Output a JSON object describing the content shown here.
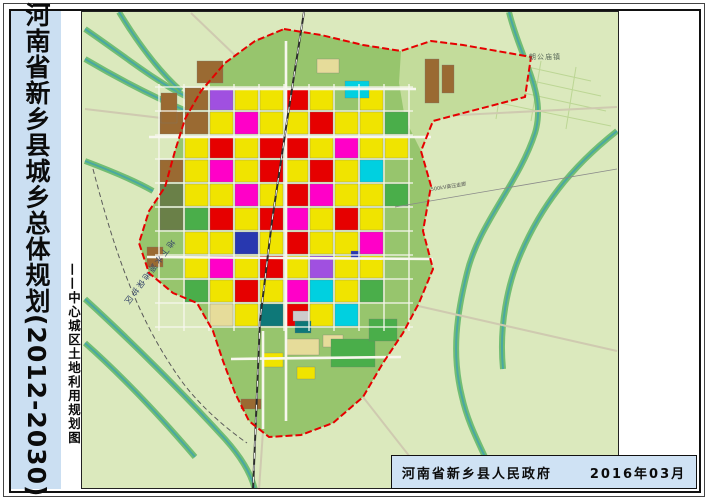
{
  "page": {
    "title_vertical": "河南省新乡县城乡总体规划(2012-2030)",
    "subtitle_vertical": "——中心城区土地利用规划图",
    "publisher": "河南省新乡县人民政府",
    "date": "2016年03月"
  },
  "compass": {
    "north_label": "N"
  },
  "scalebar": {
    "labels": [
      "500",
      "0",
      "500",
      "1000",
      "1500",
      "2000m"
    ]
  },
  "legend": {
    "title": "图 例",
    "items": [
      {
        "label": "二类居住用地",
        "color": "#f5ec00",
        "style": "solid"
      },
      {
        "label": "行政办公用地",
        "color": "#ff00c8",
        "style": "solid"
      },
      {
        "label": "文化设施用地",
        "color": "#e478dc",
        "style": "solid"
      },
      {
        "label": "教育科研用地",
        "color": "#ff8c8c",
        "style": "solid"
      },
      {
        "label": "中小学用地",
        "color": "#ff8c8c",
        "style": "stripes"
      },
      {
        "label": "医疗卫生用地",
        "color": "#ff9aa0",
        "style": "cross"
      },
      {
        "label": "社会福利用地",
        "color": "#ff78a0",
        "style": "solid"
      },
      {
        "label": "宗教用地",
        "color": "#d29020",
        "style": "solid"
      },
      {
        "label": "商业用地",
        "color": "#ff0000",
        "style": "solid"
      },
      {
        "label": "市场用地",
        "color": "#f03060",
        "style": "solid"
      },
      {
        "label": "商务用地",
        "color": "#d83050",
        "style": "solid"
      },
      {
        "label": "娱乐康体用地",
        "color": "#ff5c9e",
        "style": "solid"
      },
      {
        "label": "加油加气站用地",
        "color": "#a81028",
        "style": "solid"
      },
      {
        "label": "公用设施营业网点用地",
        "color": "#e84868",
        "style": "solid"
      },
      {
        "label": "一类工业用地",
        "color": "#d7b285",
        "style": "solid"
      },
      {
        "label": "二类工业用地",
        "color": "#b5855a",
        "style": "solid"
      },
      {
        "label": "三类工业用地",
        "color": "#8a5a32",
        "style": "solid"
      },
      {
        "label": "物流仓储用地",
        "color": "#a86ad8",
        "style": "solid"
      },
      {
        "label": "交通枢纽用地",
        "color": "#8f8f8f",
        "style": "solid"
      },
      {
        "label": "公交首末站用地",
        "color": "#a8a8a8",
        "style": "solid"
      },
      {
        "label": "社会停车场用地",
        "color": "#c4c4cc",
        "style": "solid"
      },
      {
        "label": "供水设施用地",
        "color": "#38bcd8",
        "style": "solid"
      },
      {
        "label": "供电设施用地",
        "color": "#2638a8",
        "style": "solid"
      },
      {
        "label": "通信设施用地",
        "color": "#4868d0",
        "style": "solid"
      },
      {
        "label": "污水处理厂",
        "color": "#0e7878",
        "style": "solid"
      },
      {
        "label": "消防设施用地",
        "color": "#3048c0",
        "style": "solid"
      },
      {
        "label": "公园绿地",
        "color": "#2fae4f",
        "style": "solid"
      },
      {
        "label": "防护绿地",
        "color": "#67b967",
        "style": "solid"
      },
      {
        "label": "广场用地",
        "color": "#d9d9d9",
        "style": "solid"
      },
      {
        "label": "水域",
        "color": "#a6daf2",
        "style": "solid"
      },
      {
        "label": "农林用地",
        "color": "#cbe6a4",
        "style": "solid"
      },
      {
        "label": "军事用地",
        "color": "#4f7a42",
        "style": "solid"
      },
      {
        "label": "新农村社区建设用地",
        "color": "#e9e2a6",
        "style": "solid"
      },
      {
        "label": "城市规划范围",
        "color": "#ffffff",
        "style": "boundary"
      }
    ]
  },
  "map": {
    "colors": {
      "bg": "#dbe9bd",
      "urban": "#97c56d",
      "ne_fields": "#c3dc9b",
      "water": "#49a8a2",
      "bank": "#66b86a",
      "road_out": "#cfcab0",
      "street": "#f7f7ee",
      "rail": "#2c2c2c",
      "boundary": "#e60000",
      "protect": "#5a5a5a",
      "powerline": "#8a8a8a"
    },
    "palette": {
      "Y": "#f0e400",
      "R": "#e60000",
      "M": "#ff00c8",
      "B": "#9a6a32",
      "P": "#a050e0",
      "C": "#00d0e0",
      "G": "#4aae4a",
      "E": "#2838b0",
      "T": "#0e7878",
      "K": "#e6dc9a",
      "L": "#6a8048",
      "A": "#cccccc"
    },
    "boundary_path": "M283,28 L320,34 L362,44 L400,50 L430,40 L462,44 L530,56 L524,96 L470,110 L432,120 L420,150 L430,185 L422,230 L432,268 L418,302 L402,332 L382,362 L362,396 L332,422 L300,434 L268,436 L248,420 L234,392 L222,360 L212,330 L196,302 L172,292 L148,272 L138,242 L148,210 L164,186 L174,150 L184,118 L200,90 L224,62 L254,40 Z",
    "ne_fields_path": "M400,50 L430,40 L462,44 L530,56 L524,96 L470,110 L432,120 L420,150 L404,118 L398,82 Z",
    "canals": [
      "M508,11 C520,60 546,92 534,132 C518,182 478,222 466,272 C456,312 450,352 461,396 C469,432 488,458 497,489",
      "M616,130 C568,168 540,206 520,252 C506,284 498,326 502,368",
      "M84,28 C122,54 154,80 186,96",
      "M118,11 C138,44 160,72 180,90",
      "M84,58 C128,84 162,100 190,112",
      "M84,298 C130,340 182,392 224,438 C240,456 250,472 254,489",
      "M84,342 C120,374 158,414 194,456",
      "M84,160 C116,172 138,182 152,190"
    ],
    "outer_roads": [
      "M420,116 L616,106",
      "M404,302 L616,350",
      "M186,120 L84,108",
      "M240,60 L190,12",
      "M362,396 L420,470",
      "M262,430 L258,489"
    ],
    "field_lines": [
      "M440,60 L600,95",
      "M445,75 L605,110",
      "M450,92 L610,125",
      "M436,46 L590,80",
      "M470,50 L460,115",
      "M505,55 L495,118",
      "M540,60 L530,120",
      "M575,66 L565,128"
    ],
    "major_roads": [
      "M285,40 L285,420",
      "M148,136 L430,136",
      "M146,256 L432,258",
      "M200,88 L415,88",
      "M262,330 L262,428",
      "M230,358 L400,356"
    ],
    "railway": "M303,11 L286,120 L271,220 L259,320 L252,489",
    "protect_line": "M92,168 C112,244 134,316 182,382 C202,408 226,428 246,442",
    "power_line": "M394,206 L616,168",
    "grid": {
      "x0": 158,
      "y0": 86,
      "cw": 25,
      "ch": 24,
      "rows": [
        ".BPYYRY.Y.",
        "BBYMYYRYYG",
        ".YRYRRYMYY",
        "BYMYRYRYC.",
        "LYYMYRMYYG",
        "LGRYRMYRY.",
        ".YYEYRYYM.",
        ".YMYRYPYY.",
        ".GYRYMCYG.",
        "..KYTRYC.."
      ]
    },
    "extra_parcels": [
      {
        "x": 196,
        "y": 60,
        "w": 26,
        "h": 22,
        "c": "B"
      },
      {
        "x": 160,
        "y": 92,
        "w": 16,
        "h": 30,
        "c": "B"
      },
      {
        "x": 424,
        "y": 58,
        "w": 14,
        "h": 44,
        "c": "B"
      },
      {
        "x": 441,
        "y": 64,
        "w": 12,
        "h": 28,
        "c": "B"
      },
      {
        "x": 344,
        "y": 80,
        "w": 24,
        "h": 17,
        "c": "C"
      },
      {
        "x": 316,
        "y": 58,
        "w": 22,
        "h": 14,
        "c": "K"
      },
      {
        "x": 286,
        "y": 338,
        "w": 32,
        "h": 16,
        "c": "K"
      },
      {
        "x": 322,
        "y": 334,
        "w": 20,
        "h": 12,
        "c": "K"
      },
      {
        "x": 330,
        "y": 338,
        "w": 44,
        "h": 28,
        "c": "G"
      },
      {
        "x": 368,
        "y": 318,
        "w": 28,
        "h": 22,
        "c": "G"
      },
      {
        "x": 294,
        "y": 320,
        "w": 16,
        "h": 12,
        "c": "T"
      },
      {
        "x": 350,
        "y": 250,
        "w": 9,
        "h": 8,
        "c": "E"
      },
      {
        "x": 292,
        "y": 310,
        "w": 16,
        "h": 10,
        "c": "A"
      },
      {
        "x": 240,
        "y": 398,
        "w": 20,
        "h": 10,
        "c": "B"
      },
      {
        "x": 146,
        "y": 246,
        "w": 16,
        "h": 20,
        "c": "B"
      },
      {
        "x": 262,
        "y": 352,
        "w": 20,
        "h": 14,
        "c": "Y"
      },
      {
        "x": 296,
        "y": 366,
        "w": 18,
        "h": 12,
        "c": "Y"
      }
    ],
    "labels": [
      {
        "text": "朗公庙镇",
        "x": 528,
        "y": 58,
        "rotate": 0,
        "size": 7,
        "color": "#5a6a5a",
        "spacing": 1
      },
      {
        "text": "地下水源地保护区",
        "x": 170,
        "y": 238,
        "rotate": 127,
        "size": 8,
        "color": "#37476b",
        "spacing": 2
      },
      {
        "text": "500kV高压走廊",
        "x": 430,
        "y": 190,
        "rotate": -9,
        "size": 5,
        "color": "#555555",
        "spacing": 0
      }
    ]
  }
}
